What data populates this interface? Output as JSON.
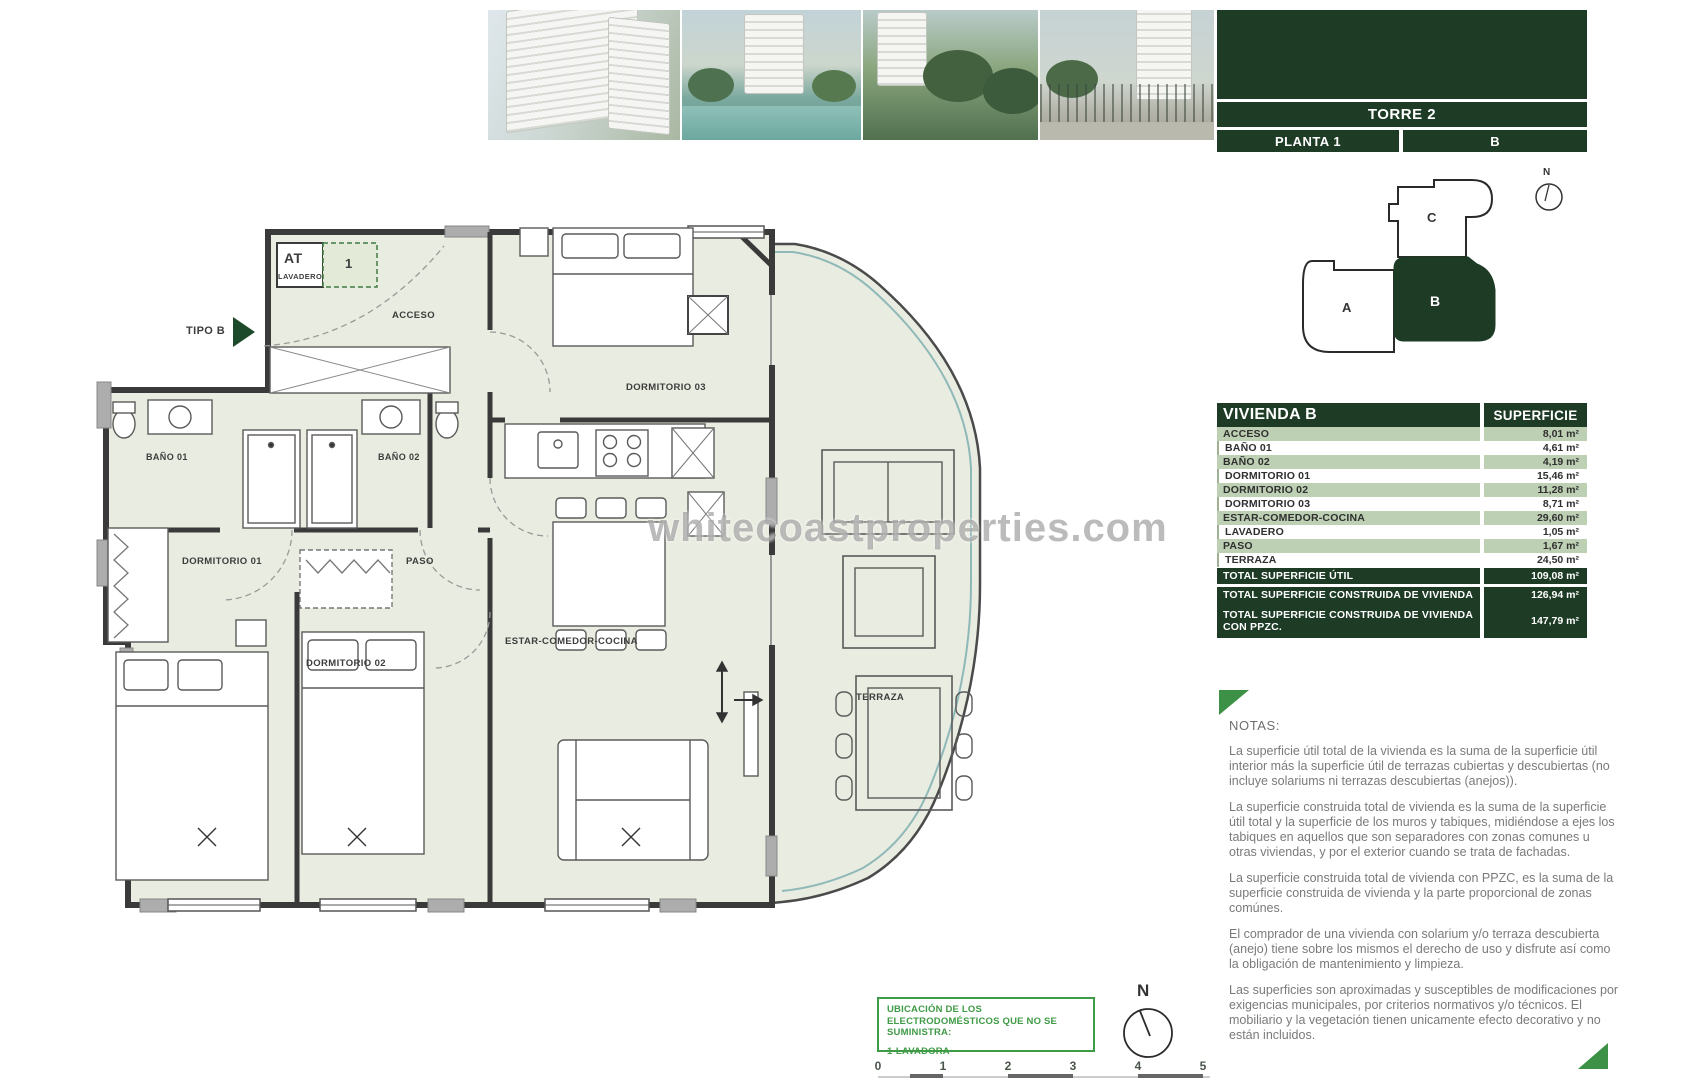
{
  "watermark": "whitecoastproperties.com",
  "panel": {
    "torre": "TORRE 2",
    "planta": "PLANTA 1",
    "letra": "B",
    "keyplan": {
      "a": "A",
      "b": "B",
      "c": "C",
      "north": "N"
    }
  },
  "table": {
    "header": {
      "name": "VIVIENDA B",
      "superficie": "SUPERFICIE"
    },
    "rows": [
      {
        "label": "ACCESO",
        "value": "8,01 m²"
      },
      {
        "label": "BAÑO 01",
        "value": "4,61 m²"
      },
      {
        "label": "BAÑO 02",
        "value": "4,19 m²"
      },
      {
        "label": "DORMITORIO 01",
        "value": "15,46 m²"
      },
      {
        "label": "DORMITORIO 02",
        "value": "11,28 m²"
      },
      {
        "label": "DORMITORIO 03",
        "value": "8,71 m²"
      },
      {
        "label": "ESTAR-COMEDOR-COCINA",
        "value": "29,60 m²"
      },
      {
        "label": "LAVADERO",
        "value": "1,05 m²"
      },
      {
        "label": "PASO",
        "value": "1,67 m²"
      },
      {
        "label": "TERRAZA",
        "value": "24,50 m²"
      }
    ],
    "totals": [
      {
        "label": "TOTAL SUPERFICIE ÚTIL",
        "value": "109,08 m²"
      },
      {
        "label": "TOTAL SUPERFICIE CONSTRUIDA DE VIVIENDA",
        "value": "126,94 m²"
      },
      {
        "label": "TOTAL SUPERFICIE CONSTRUIDA DE VIVIENDA CON PPZC.",
        "value": "147,79 m²"
      }
    ]
  },
  "notes": {
    "title": "NOTAS:",
    "paragraphs": [
      "La superficie útil total de la vivienda es la suma de la superficie útil interior más la superficie útil de terrazas cubiertas y descubiertas (no incluye solariums ni terrazas descubiertas (anejos)).",
      "La superficie construida total de vivienda es la suma de la superficie útil total y la superficie de los muros y tabiques, midiéndose a ejes los tabiques en aquellos que son separadores con zonas comunes u otras viviendas, y por el exterior cuando se trata de fachadas.",
      "La superficie construida total de vivienda con PPZC, es la suma de la superficie construida de vivienda y la parte proporcional de zonas comúnes.",
      "El comprador de una vivienda con solarium y/o terraza descubierta (anejo) tiene sobre los mismos el derecho de uso y disfrute así como la obligación de mantenimiento y limpieza.",
      "Las superficies son aproximadas y susceptibles de modificaciones por exigencias municipales, por criterios normativos y/o técnicos. El mobiliario y la vegetación tienen unicamente efecto decorativo y no están incluidos."
    ]
  },
  "plan": {
    "tipo": "TIPO B",
    "at": "AT",
    "lavadero_small": "LAVADERO",
    "one": "1",
    "acceso": "ACCESO",
    "bano01": "BAÑO 01",
    "bano02": "BAÑO 02",
    "dormitorio01": "DORMITORIO 01",
    "dormitorio02": "DORMITORIO 02",
    "dormitorio03": "DORMITORIO 03",
    "paso": "PASO",
    "estar": "ESTAR-COMEDOR-COCINA",
    "terraza": "TERRAZA"
  },
  "appliance_box": {
    "title": "UBICACIÓN DE LOS ELECTRODOMÉSTICOS QUE NO SE SUMINISTRA:",
    "item": "1-LAVADORA"
  },
  "compass": {
    "north": "N"
  },
  "scalebar": {
    "labels": [
      "0",
      "1",
      "2",
      "3",
      "4",
      "5"
    ]
  },
  "colors": {
    "dark_green": "#1d3b25",
    "light_green": "#bed0b4",
    "accent_green": "#3f9b46",
    "floor": "#e9ece0"
  }
}
